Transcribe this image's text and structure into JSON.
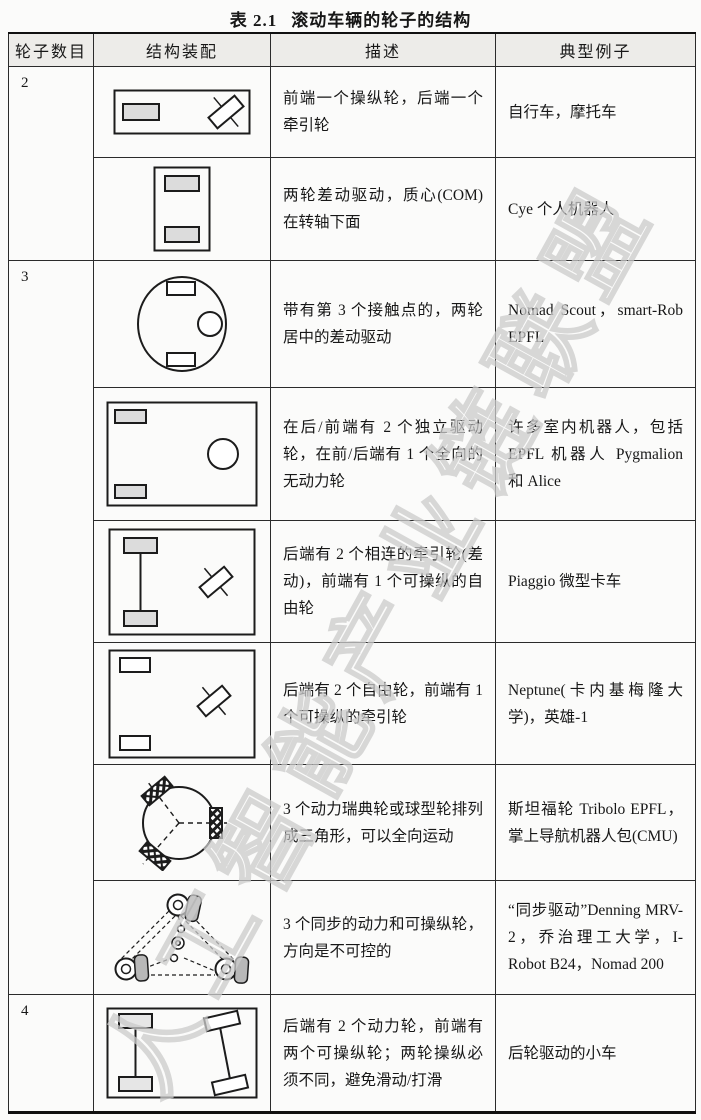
{
  "title": {
    "prefix": "表 2.1",
    "text": "滚动车辆的轮子的结构"
  },
  "watermark": {
    "text": "人工智能产业链联盟",
    "color": "#cbcbcb"
  },
  "colors": {
    "header_bg": "#edece9",
    "powered_wheel_fill": "#dcdcdc",
    "synchro_wheel_fill": "#b8b8b8",
    "line": "#1c1c1c"
  },
  "table": {
    "headers": [
      "轮子数目",
      "结构装配",
      "描述",
      "典型例子"
    ],
    "groups": [
      {
        "count": "2"
      },
      {
        "count": "3"
      },
      {
        "count": "4"
      }
    ],
    "rows": [
      {
        "diagram": "steered-front-traction-rear-diagram",
        "description": "前端一个操纵轮，后端一个牵引轮",
        "examples": "自行车，摩托车"
      },
      {
        "diagram": "two-wheel-differential-com-diagram",
        "description": "两轮差动驱动，质心(COM)在转轴下面",
        "examples": "Cye 个人机器人"
      },
      {
        "diagram": "centered-differential-third-contact-diagram",
        "description": "带有第 3 个接触点的，两轮居中的差动驱动",
        "examples": "Nomad Scout，smart-Rob EPFL"
      },
      {
        "diagram": "two-independent-drive-omni-diagram",
        "description": "在后/前端有 2 个独立驱动轮，在前/后端有 1 个全向的无动力轮",
        "examples": "许多室内机器人，包括 EPFL 机器人 Pygmalion 和 Alice"
      },
      {
        "diagram": "connected-traction-steered-free-diagram",
        "description": "后端有 2 个相连的牵引轮(差动)，前端有 1 个可操纵的自由轮",
        "examples": "Piaggio 微型卡车"
      },
      {
        "diagram": "two-free-steered-traction-diagram",
        "description": "后端有 2 个自由轮，前端有 1 个可操纵的牵引轮",
        "examples": "Neptune(卡内基梅隆大学)，英雄-1"
      },
      {
        "diagram": "three-swedish-omni-diagram",
        "description": "3 个动力瑞典轮或球型轮排列成三角形，可以全向运动",
        "examples": "斯坦福轮 Tribolo EPFL，掌上导航机器人包(CMU)"
      },
      {
        "diagram": "synchro-drive-diagram",
        "description": "3 个同步的动力和可操纵轮，方向是不可控的",
        "examples": "“同步驱动”Denning MRV-2，乔治理工大学，I-Robot B24，Nomad 200"
      },
      {
        "diagram": "four-wheel-ackermann-diagram",
        "description": "后端有 2 个动力轮，前端有两个可操纵轮；两轮操纵必须不同，避免滑动/打滑",
        "examples": "后轮驱动的小车"
      }
    ]
  }
}
